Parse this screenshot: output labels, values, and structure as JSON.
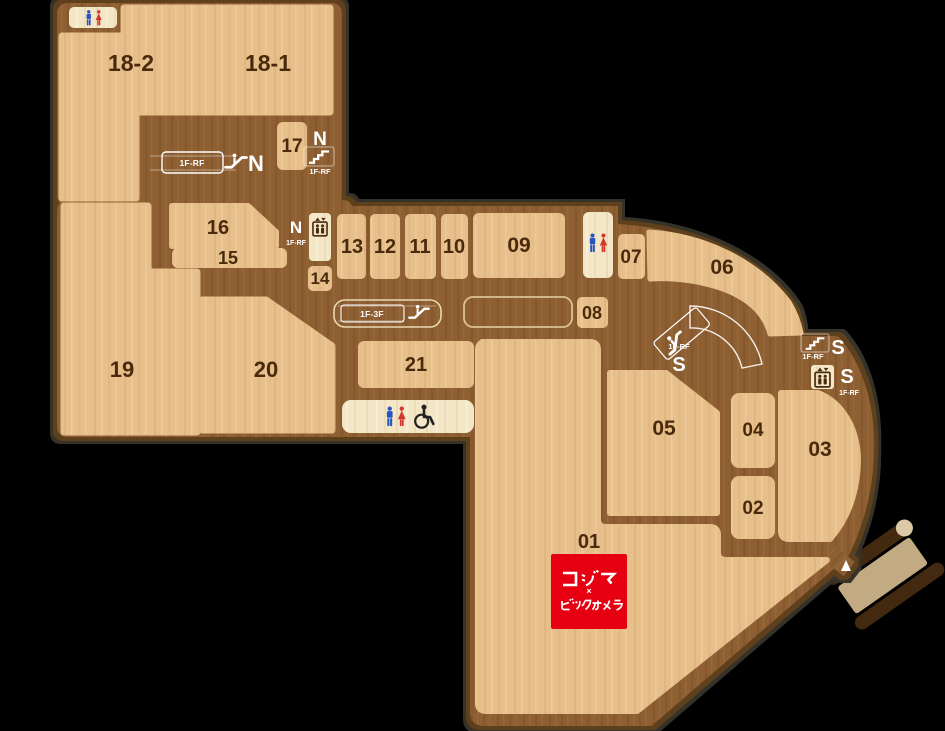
{
  "map_name": "mall-floor-plan-1f",
  "units": {
    "u18_2": {
      "label": "18-2"
    },
    "u18_1": {
      "label": "18-1"
    },
    "u17": {
      "label": "17"
    },
    "u16": {
      "label": "16"
    },
    "u15": {
      "label": "15"
    },
    "u14": {
      "label": "14"
    },
    "u13": {
      "label": "13"
    },
    "u12": {
      "label": "12"
    },
    "u11": {
      "label": "11"
    },
    "u10": {
      "label": "10"
    },
    "u09": {
      "label": "09"
    },
    "u08": {
      "label": "08"
    },
    "u07": {
      "label": "07"
    },
    "u06": {
      "label": "06"
    },
    "u05": {
      "label": "05"
    },
    "u04": {
      "label": "04"
    },
    "u03": {
      "label": "03"
    },
    "u02": {
      "label": "02"
    },
    "u01": {
      "label": "01"
    },
    "u19": {
      "label": "19"
    },
    "u20": {
      "label": "20"
    },
    "u21": {
      "label": "21"
    }
  },
  "facilities": {
    "restroom_northwest": {
      "name": "restroom",
      "icons": [
        "male",
        "female"
      ]
    },
    "restroom_central": {
      "name": "restroom",
      "icons": [
        "male",
        "female"
      ]
    },
    "restroom_south": {
      "name": "restroom-accessible",
      "icons": [
        "male",
        "female",
        "wheelchair"
      ]
    },
    "escalator_north": {
      "zone": "N",
      "floors": "1F-RF"
    },
    "stairs_north": {
      "zone": "N",
      "floors": "1F-RF"
    },
    "elevator_north": {
      "zone": "N",
      "floors": "1F-RF"
    },
    "escalator_central": {
      "floors": "1F-3F"
    },
    "escalator_south": {
      "zone": "S",
      "floors": "1F-RF"
    },
    "stairs_south": {
      "zone": "S",
      "floors": "1F-RF"
    },
    "elevator_south": {
      "zone": "S",
      "floors": "1F-RF"
    }
  },
  "store": {
    "unit": "01",
    "line1": "コジマ",
    "separator": "×",
    "line2": "ビックカメラ",
    "brand_bg": "#e60012",
    "brand_fg": "#ffffff"
  },
  "colors": {
    "corridor": "#8d5f30",
    "unit_fill": "#e7bf8b",
    "facility_fill": "#f3e7c7",
    "rim_inner": "#5e411f",
    "rim_outer": "#34302b",
    "label_text": "#4a2a0d",
    "restroom_male": "#2753c4",
    "restroom_female": "#d0372e"
  }
}
